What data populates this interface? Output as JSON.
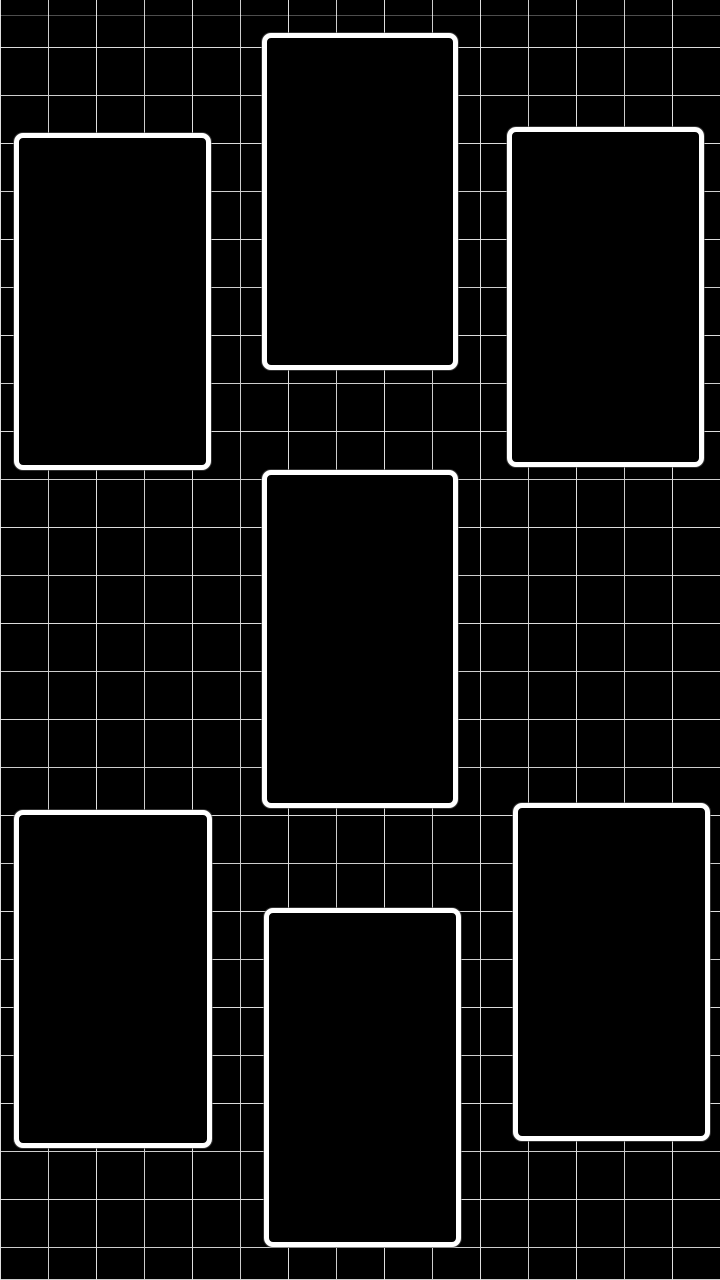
{
  "canvas": {
    "width": 720,
    "height": 1280,
    "description": "black grid wallpaper collage template with seven empty photo frames"
  },
  "colors": {
    "background": "#000000",
    "grid_line": "#cdcdcd",
    "frame_border": "#ffffff",
    "frame_fill": "#000000"
  },
  "grid": {
    "cell_size_px": 48,
    "line_thickness_px": 1
  },
  "frames": [
    {
      "id": "photo-frame-top-left",
      "x": 14,
      "y": 133,
      "width": 197,
      "height": 337
    },
    {
      "id": "photo-frame-top-center",
      "x": 262,
      "y": 33,
      "width": 196,
      "height": 337
    },
    {
      "id": "photo-frame-top-right",
      "x": 507,
      "y": 127,
      "width": 197,
      "height": 340
    },
    {
      "id": "photo-frame-middle-center",
      "x": 262,
      "y": 470,
      "width": 196,
      "height": 338
    },
    {
      "id": "photo-frame-bottom-left",
      "x": 14,
      "y": 810,
      "width": 198,
      "height": 338
    },
    {
      "id": "photo-frame-bottom-center",
      "x": 264,
      "y": 908,
      "width": 197,
      "height": 339
    },
    {
      "id": "photo-frame-bottom-right",
      "x": 513,
      "y": 803,
      "width": 197,
      "height": 338
    }
  ]
}
